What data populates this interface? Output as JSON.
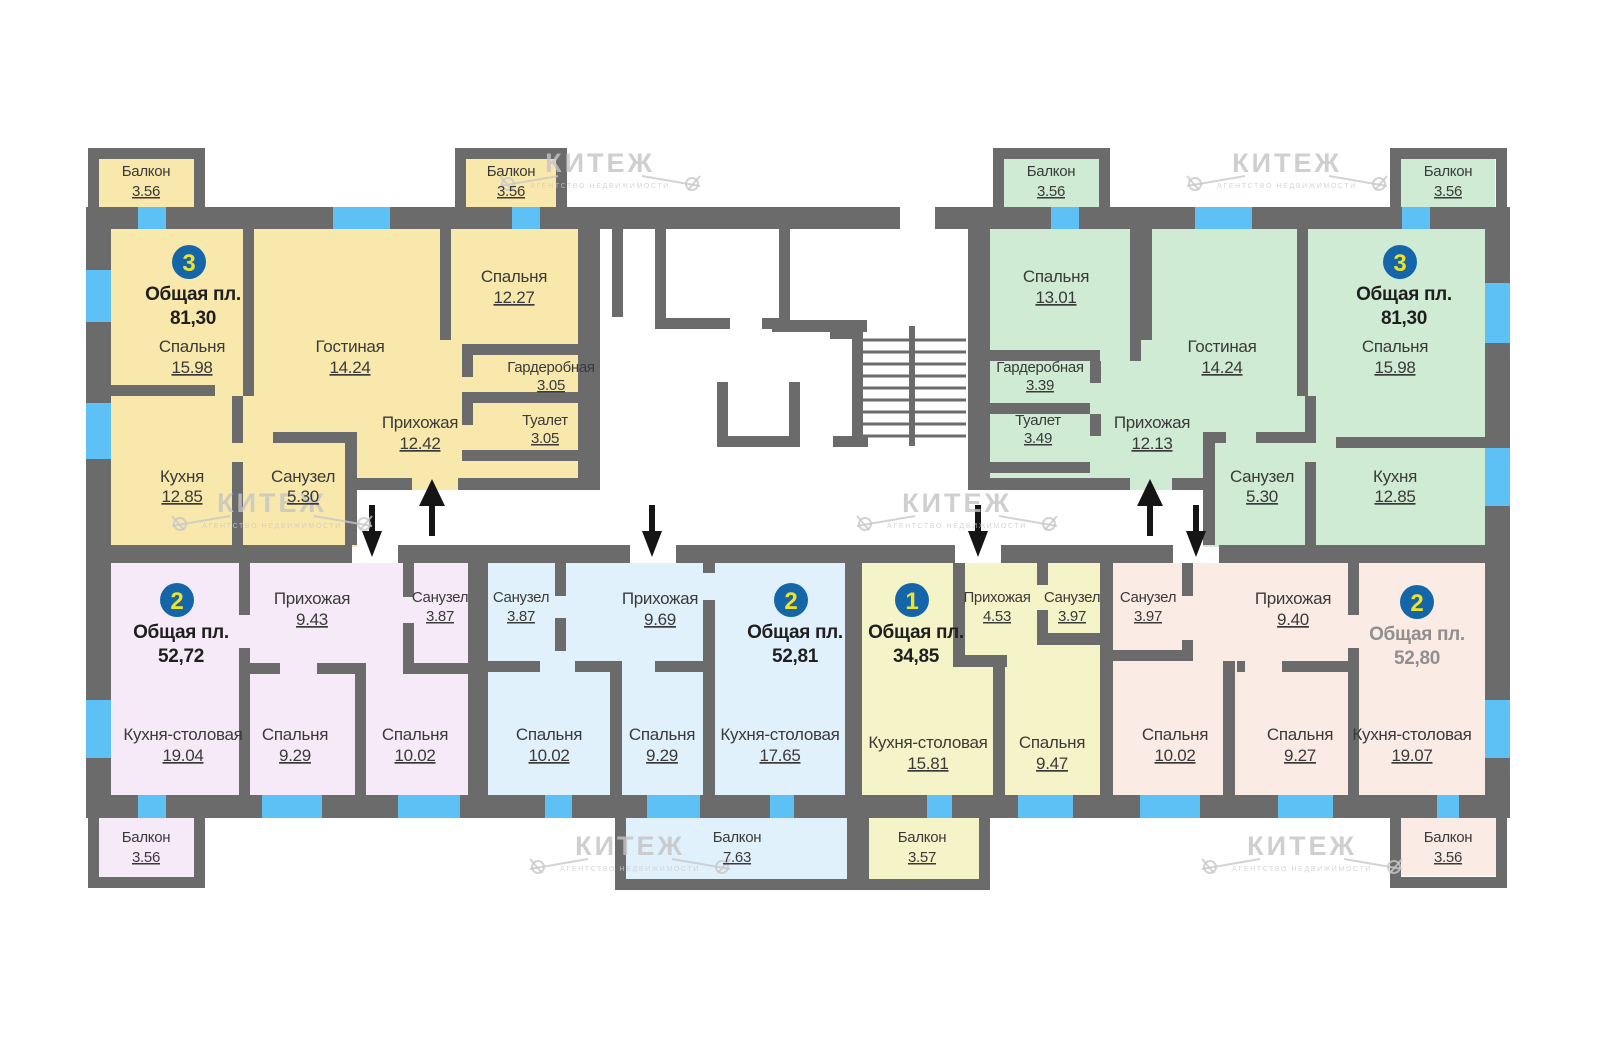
{
  "watermark": {
    "brand": "КИТЕЖ",
    "subtitle": "АГЕНТСТВО НЕДВИЖИМОСТИ"
  },
  "colors": {
    "wall": "#6B6B6B",
    "window": "#5EC1F5",
    "badge_bg": "#1466A8",
    "badge_number": "#EFE229",
    "label": "#3A3A3A",
    "muted_total": "#8F8F8F",
    "watermark": "#C4C4C4"
  },
  "apartments": {
    "left3": {
      "badge": "3",
      "total_label": "Общая пл.",
      "total": "81,30",
      "color": "#F8E8AC",
      "balcony1": {
        "name": "Балкон",
        "area": "3.56"
      },
      "balcony2": {
        "name": "Балкон",
        "area": "3.56"
      },
      "bedroom1": {
        "name": "Спальня",
        "area": "15.98"
      },
      "living": {
        "name": "Гостиная",
        "area": "14.24"
      },
      "bedroom2": {
        "name": "Спальня",
        "area": "12.27"
      },
      "wardrobe": {
        "name": "Гардеробная",
        "area": "3.05"
      },
      "wc": {
        "name": "Туалет",
        "area": "3.05"
      },
      "hallway": {
        "name": "Прихожая",
        "area": "12.42"
      },
      "kitchen": {
        "name": "Кухня",
        "area": "12.85"
      },
      "bath": {
        "name": "Санузел",
        "area": "5.30"
      }
    },
    "right3": {
      "badge": "3",
      "total_label": "Общая пл.",
      "total": "81,30",
      "color": "#CFEBD3",
      "balcony1": {
        "name": "Балкон",
        "area": "3.56"
      },
      "balcony2": {
        "name": "Балкон",
        "area": "3.56"
      },
      "bedroom1": {
        "name": "Спальня",
        "area": "13.01"
      },
      "living": {
        "name": "Гостиная",
        "area": "14.24"
      },
      "bedroom2": {
        "name": "Спальня",
        "area": "15.98"
      },
      "wardrobe": {
        "name": "Гардеробная",
        "area": "3.39"
      },
      "wc": {
        "name": "Туалет",
        "area": "3.49"
      },
      "hallway": {
        "name": "Прихожая",
        "area": "12.13"
      },
      "bath": {
        "name": "Санузел",
        "area": "5.30"
      },
      "kitchen": {
        "name": "Кухня",
        "area": "12.85"
      }
    },
    "left2": {
      "badge": "2",
      "total_label": "Общая пл.",
      "total": "52,72",
      "color": "#F6EAF8",
      "hallway": {
        "name": "Прихожая",
        "area": "9.43"
      },
      "bath": {
        "name": "Санузел",
        "area": "3.87"
      },
      "kitchen_dining": {
        "name": "Кухня-столовая",
        "area": "19.04"
      },
      "bedroom1": {
        "name": "Спальня",
        "area": "9.29"
      },
      "bedroom2": {
        "name": "Спальня",
        "area": "10.02"
      },
      "balcony": {
        "name": "Балкон",
        "area": "3.56"
      }
    },
    "mid2": {
      "badge": "2",
      "total_label": "Общая пл.",
      "total": "52,81",
      "color": "#E1F1FC",
      "bath": {
        "name": "Санузел",
        "area": "3.87"
      },
      "hallway": {
        "name": "Прихожая",
        "area": "9.69"
      },
      "bedroom2": {
        "name": "Спальня",
        "area": "10.02"
      },
      "bedroom1": {
        "name": "Спальня",
        "area": "9.29"
      },
      "kitchen_dining": {
        "name": "Кухня-столовая",
        "area": "17.65"
      },
      "balcony": {
        "name": "Балкон",
        "area": "7.63"
      }
    },
    "one1": {
      "badge": "1",
      "total_label": "Общая пл.",
      "total": "34,85",
      "color": "#F5F4C8",
      "hallway": {
        "name": "Прихожая",
        "area": "4.53"
      },
      "bath": {
        "name": "Санузел",
        "area": "3.97"
      },
      "kitchen_dining": {
        "name": "Кухня-столовая",
        "area": "15.81"
      },
      "bedroom": {
        "name": "Спальня",
        "area": "9.47"
      },
      "balcony": {
        "name": "Балкон",
        "area": "3.57"
      }
    },
    "right2": {
      "badge": "2",
      "total_label": "Общая пл.",
      "total": "52,80",
      "color": "#FBEBE5",
      "bath": {
        "name": "Санузел",
        "area": "3.97"
      },
      "hallway": {
        "name": "Прихожая",
        "area": "9.40"
      },
      "bedroom1": {
        "name": "Спальня",
        "area": "10.02"
      },
      "bedroom2": {
        "name": "Спальня",
        "area": "9.27"
      },
      "kitchen_dining": {
        "name": "Кухня-столовая",
        "area": "19.07"
      },
      "balcony": {
        "name": "Балкон",
        "area": "3.56"
      }
    }
  }
}
